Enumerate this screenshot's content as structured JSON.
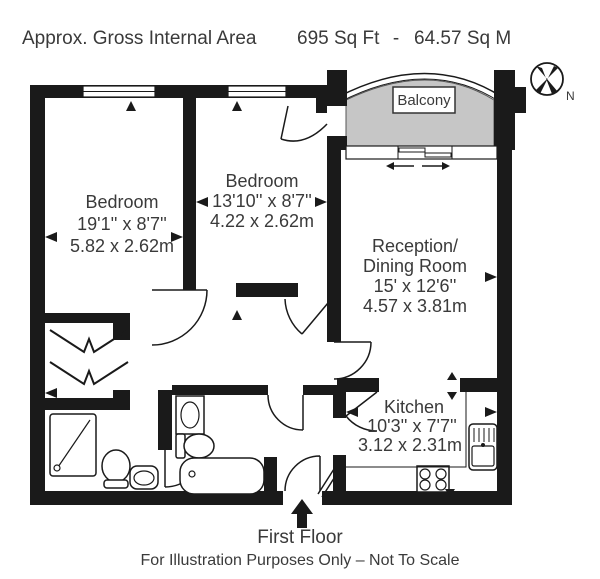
{
  "header": {
    "title": "Approx. Gross Internal Area",
    "area_ft": "695 Sq Ft",
    "separator": "-",
    "area_m": "64.57 Sq M"
  },
  "compass": {
    "north_label": "N"
  },
  "rooms": [
    {
      "id": "bedroom-1",
      "name": "Bedroom",
      "dimensions_imperial": "19'1'' x 8'7''",
      "dimensions_metric": "5.82 x 2.62m"
    },
    {
      "id": "bedroom-2",
      "name": "Bedroom",
      "dimensions_imperial": "13'10'' x 8'7''",
      "dimensions_metric": "4.22 x 2.62m"
    },
    {
      "id": "reception",
      "name": "Reception/",
      "name_line2": "Dining Room",
      "dimensions_imperial": "15' x 12'6''",
      "dimensions_metric": "4.57 x 3.81m"
    },
    {
      "id": "kitchen",
      "name": "Kitchen",
      "dimensions_imperial": "10'3'' x 7'7''",
      "dimensions_metric": "3.12 x 2.31m"
    },
    {
      "id": "balcony",
      "name": "Balcony"
    }
  ],
  "fixtures": [
    "shower",
    "toilet",
    "hand-basin",
    "washbasin",
    "toilet",
    "bathtub",
    "kitchen-sink",
    "hob",
    "wardrobe-bifold-doors",
    "sliding-balcony-door"
  ],
  "footer": {
    "floor_label": "First Floor",
    "disclaimer": "For Illustration Purposes Only – Not To Scale"
  },
  "colors": {
    "wall": "#1a1a1a",
    "balcony_fill": "#c6c6c6",
    "text": "#3a3a3a",
    "background": "#ffffff"
  }
}
